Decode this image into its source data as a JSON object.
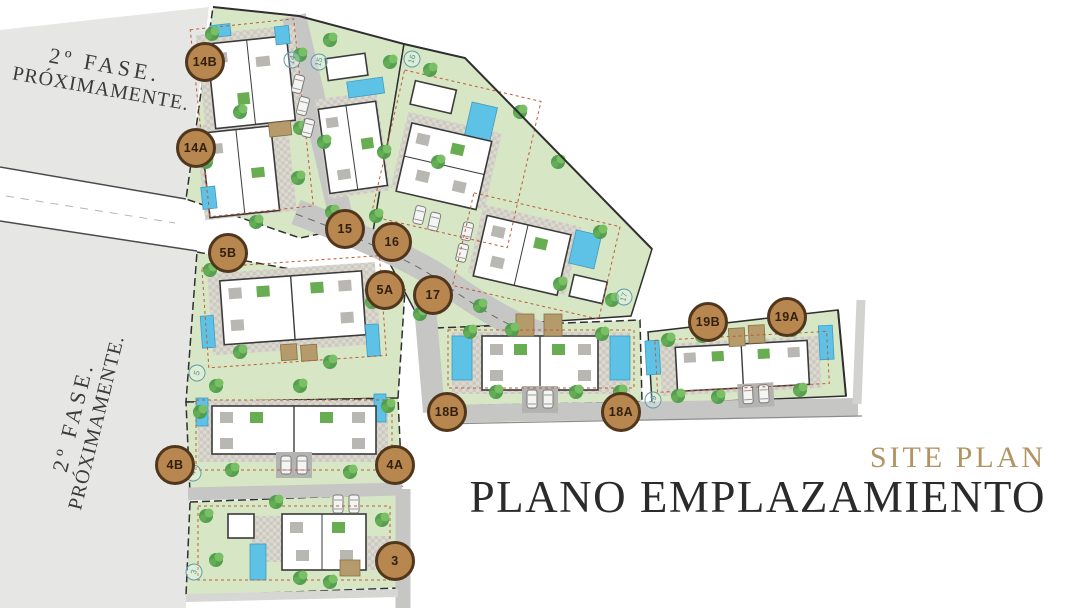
{
  "titles": {
    "subtitle_en": "SITE PLAN",
    "title_es": "PLANO EMPLAZAMIENTO"
  },
  "phase_notices": [
    {
      "id": "top-left",
      "line1": "2º FASE.",
      "line2": "PRÓXIMAMENTE."
    },
    {
      "id": "left",
      "line1": "2º FASE.",
      "line2": "PRÓXIMAMENTE."
    }
  ],
  "plot_badges": [
    {
      "label": "14B",
      "x": 205,
      "y": 62
    },
    {
      "label": "14A",
      "x": 196,
      "y": 148
    },
    {
      "label": "15",
      "x": 345,
      "y": 229
    },
    {
      "label": "16",
      "x": 392,
      "y": 242
    },
    {
      "label": "5B",
      "x": 228,
      "y": 253
    },
    {
      "label": "5A",
      "x": 385,
      "y": 290
    },
    {
      "label": "17",
      "x": 433,
      "y": 295
    },
    {
      "label": "18B",
      "x": 447,
      "y": 412
    },
    {
      "label": "18A",
      "x": 621,
      "y": 412
    },
    {
      "label": "19B",
      "x": 708,
      "y": 322
    },
    {
      "label": "19A",
      "x": 787,
      "y": 317
    },
    {
      "label": "4B",
      "x": 175,
      "y": 465
    },
    {
      "label": "4A",
      "x": 395,
      "y": 465
    },
    {
      "label": "3",
      "x": 395,
      "y": 561
    }
  ],
  "mini_plot_labels": [
    {
      "label": "14",
      "x": 292,
      "y": 60
    },
    {
      "label": "15",
      "x": 319,
      "y": 62
    },
    {
      "label": "16",
      "x": 412,
      "y": 59
    },
    {
      "label": "17",
      "x": 624,
      "y": 297
    },
    {
      "label": "19",
      "x": 653,
      "y": 400
    },
    {
      "label": "5",
      "x": 197,
      "y": 373
    },
    {
      "label": "4",
      "x": 193,
      "y": 473
    },
    {
      "label": "3",
      "x": 194,
      "y": 572
    }
  ],
  "palette": {
    "badge_fill": "#b8864f",
    "badge_border": "#50361c",
    "badge_text": "#32200e",
    "accent_gold": "#b29463",
    "title_color": "#2b2b2b",
    "plot_green": "#d7e7c5",
    "road_gray": "#c6c6c4",
    "phase_area_gray": "#e6e6e5",
    "pool_blue": "#5ec2e6",
    "tree_green": "#4e9b4a",
    "setback_red": "#bf5b38",
    "mini_label_teal": "#4d93a8"
  }
}
